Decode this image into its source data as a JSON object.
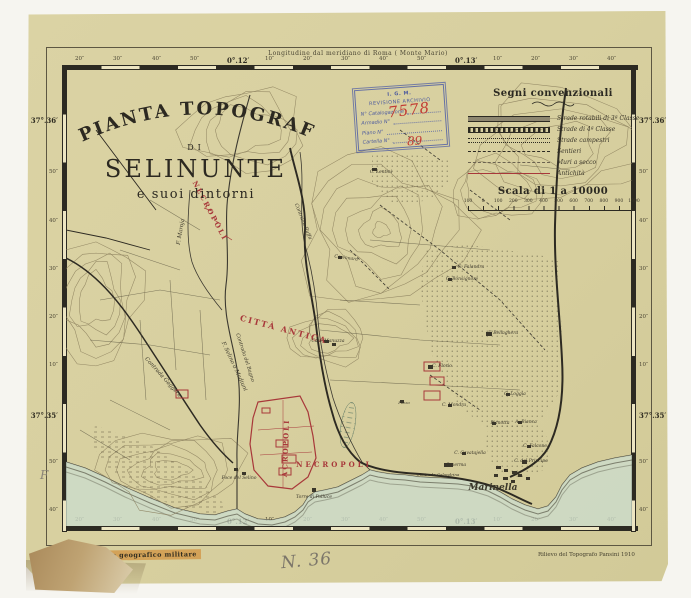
{
  "sheet": {
    "title_arc": "PIANTA TOPOGRAFICA",
    "title_di": "DI",
    "title_main": "SELINUNTE",
    "title_sub": "e suoi dintorni",
    "top_edge_label": "Longitudine dal meridiano di Roma ( Monte Mario)",
    "bottom_left_stamp": "Istituto geografico militare",
    "bottom_right_credit": "Rilievo del Topografo Pansini  1910",
    "handwritten_number": "N. 36",
    "handwritten_letter": "F"
  },
  "archive_stamp": {
    "line1": "I. G. M.",
    "line2": "REVISIONE ARCHIVIO",
    "fields": [
      {
        "label": "N° Catalogazione",
        "value": "7578"
      },
      {
        "label": "Armadio  N°",
        "value": ""
      },
      {
        "label": "Piano  N°",
        "value": ""
      },
      {
        "label": "Cartella  N°",
        "value": "89"
      }
    ]
  },
  "legend": {
    "title": "Segni convenzionali",
    "items": [
      {
        "label": "Strade rotabili di 3ª Classe"
      },
      {
        "label": "Strade di 4ª Classe"
      },
      {
        "label": "Strade campestri"
      },
      {
        "label": "Sentieri"
      },
      {
        "label": "Muri a secco"
      },
      {
        "label": "Antichità"
      }
    ],
    "scale_title": "Scala di 1 a 10000",
    "scale_ticks": [
      "100",
      "0",
      "100",
      "200",
      "300",
      "400",
      "500",
      "600",
      "700",
      "800",
      "900",
      "1000"
    ]
  },
  "graticule": {
    "top": [
      "20″",
      "30″",
      "40″",
      "50″",
      "0°.12′",
      "10″",
      "20″",
      "30″",
      "40″",
      "50″",
      "0°.13′",
      "10″",
      "20″",
      "30″",
      "40″"
    ],
    "bottom": [
      "20″",
      "30″",
      "40″",
      "50″",
      "0°.12′",
      "10″",
      "20″",
      "30″",
      "40″",
      "50″",
      "0°.13′",
      "10″",
      "20″",
      "30″",
      "40″"
    ],
    "left": [
      "37°.36′",
      "50″",
      "40″",
      "30″",
      "20″",
      "10″",
      "37°.35′",
      "50″",
      "40″"
    ],
    "right": [
      "37°.36′",
      "50″",
      "40″",
      "30″",
      "20″",
      "10″",
      "37°.35′",
      "50″",
      "40″"
    ]
  },
  "map": {
    "labels": [
      {
        "text": "NECROPOLI",
        "x": 142,
        "y": 142,
        "rot": 62,
        "size": 7,
        "color": "red",
        "sp": 2,
        "caps": true
      },
      {
        "text": "CITTÀ ANTICA",
        "x": 217,
        "y": 262,
        "rot": 15,
        "size": 8,
        "color": "red",
        "sp": 2,
        "caps": true
      },
      {
        "text": "ACROPOLI",
        "x": 222,
        "y": 378,
        "rot": -88,
        "size": 7,
        "color": "red",
        "sp": 2,
        "caps": true
      },
      {
        "text": "NECROPOLI",
        "x": 268,
        "y": 397,
        "rot": 0,
        "size": 7,
        "color": "red",
        "sp": 3,
        "caps": true
      },
      {
        "text": "F. Maroja",
        "x": 116,
        "y": 162,
        "rot": -80,
        "size": 5.5,
        "color": "ink"
      },
      {
        "text": "F. Selino o Madiuni",
        "x": 167,
        "y": 297,
        "rot": 65,
        "size": 5.5,
        "color": "ink"
      },
      {
        "text": "Contrada Gaggera",
        "x": 96,
        "y": 308,
        "rot": 48,
        "size": 5.5,
        "color": "ink"
      },
      {
        "text": "Contrada del Bagno",
        "x": 178,
        "y": 288,
        "rot": 72,
        "size": 5,
        "color": "ink"
      },
      {
        "text": "Contrada Buffa",
        "x": 236,
        "y": 152,
        "rot": 68,
        "size": 5,
        "color": "ink"
      },
      {
        "text": "C. Lentini",
        "x": 315,
        "y": 103,
        "rot": 0,
        "size": 4.5,
        "color": "ink"
      },
      {
        "text": "Capinnara",
        "x": 280,
        "y": 189,
        "rot": 8,
        "size": 4.5,
        "color": "ink"
      },
      {
        "text": "Case Manuzza",
        "x": 262,
        "y": 272,
        "rot": 0,
        "size": 4.5,
        "color": "ink"
      },
      {
        "text": "C. Falandra",
        "x": 405,
        "y": 198,
        "rot": 0,
        "size": 4.5,
        "color": "ink"
      },
      {
        "text": "C. Bonsignore",
        "x": 396,
        "y": 210,
        "rot": 0,
        "size": 4.5,
        "color": "ink"
      },
      {
        "text": "F. Bellaghera",
        "x": 437,
        "y": 264,
        "rot": 0,
        "size": 4.5,
        "color": "ink"
      },
      {
        "text": "C. Florio",
        "x": 376,
        "y": 297,
        "rot": 0,
        "size": 4.5,
        "color": "ink"
      },
      {
        "text": "C. Loggia",
        "x": 449,
        "y": 325,
        "rot": 0,
        "size": 4.5,
        "color": "ink"
      },
      {
        "text": "C. Mondra",
        "x": 388,
        "y": 336,
        "rot": 0,
        "size": 4.5,
        "color": "ink"
      },
      {
        "text": "Pianotta",
        "x": 434,
        "y": 354,
        "rot": 0,
        "size": 4.5,
        "color": "ink"
      },
      {
        "text": "A. Bianca",
        "x": 460,
        "y": 353,
        "rot": 0,
        "size": 4.5,
        "color": "ink"
      },
      {
        "text": "C. Falcone",
        "x": 469,
        "y": 377,
        "rot": 0,
        "size": 4.5,
        "color": "ink"
      },
      {
        "text": "C. Cavatajella",
        "x": 404,
        "y": 384,
        "rot": 0,
        "size": 4.5,
        "color": "ink"
      },
      {
        "text": "Caserma",
        "x": 390,
        "y": 396,
        "rot": 0,
        "size": 4.5,
        "color": "ink"
      },
      {
        "text": "C. del Principe",
        "x": 465,
        "y": 392,
        "rot": 0,
        "size": 4.5,
        "color": "ink"
      },
      {
        "text": "Contrada Galandrina",
        "x": 372,
        "y": 406,
        "rot": 0,
        "size": 4,
        "color": "ink"
      },
      {
        "text": "Marinella",
        "x": 427,
        "y": 420,
        "rot": 0,
        "size": 9,
        "color": "ink",
        "bold": true
      },
      {
        "text": "Foce del Selino",
        "x": 173,
        "y": 409,
        "rot": 0,
        "size": 4.5,
        "color": "ink"
      },
      {
        "text": "Torre di Polluce",
        "x": 248,
        "y": 428,
        "rot": 0,
        "size": 4.5,
        "color": "ink"
      },
      {
        "text": "Pozzo",
        "x": 338,
        "y": 334,
        "rot": 0,
        "size": 4,
        "color": "ink"
      }
    ]
  },
  "colors": {
    "paper": "#d8d0a0",
    "ink": "#3a362a",
    "antiquity_red": "#a8383a",
    "sea": "#ccdccc",
    "stamp_blue": "#3f50a5",
    "stamp_red": "#c23b33"
  }
}
